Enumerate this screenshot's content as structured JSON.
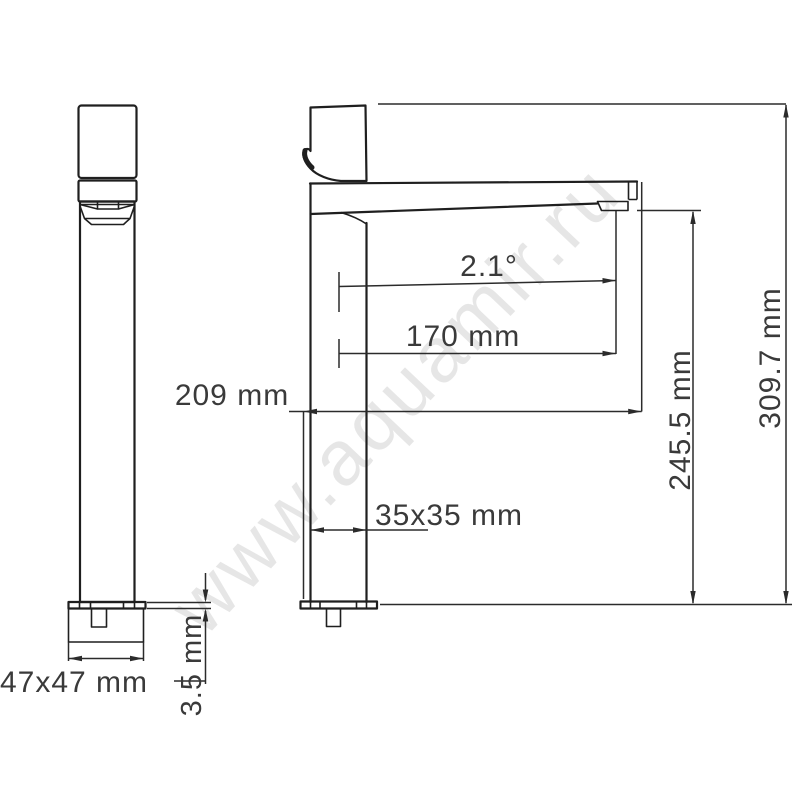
{
  "watermark": {
    "text": "www.aquamir.ru"
  },
  "dimensions": {
    "base_footprint": "47x47 mm",
    "flange_thickness": "3.5 mm",
    "spout_angle": "2.1°",
    "spout_reach": "170 mm",
    "spout_projection": "209 mm",
    "body_section": "35x35 mm",
    "outlet_height": "245.5 mm",
    "overall_height": "309.7 mm"
  }
}
